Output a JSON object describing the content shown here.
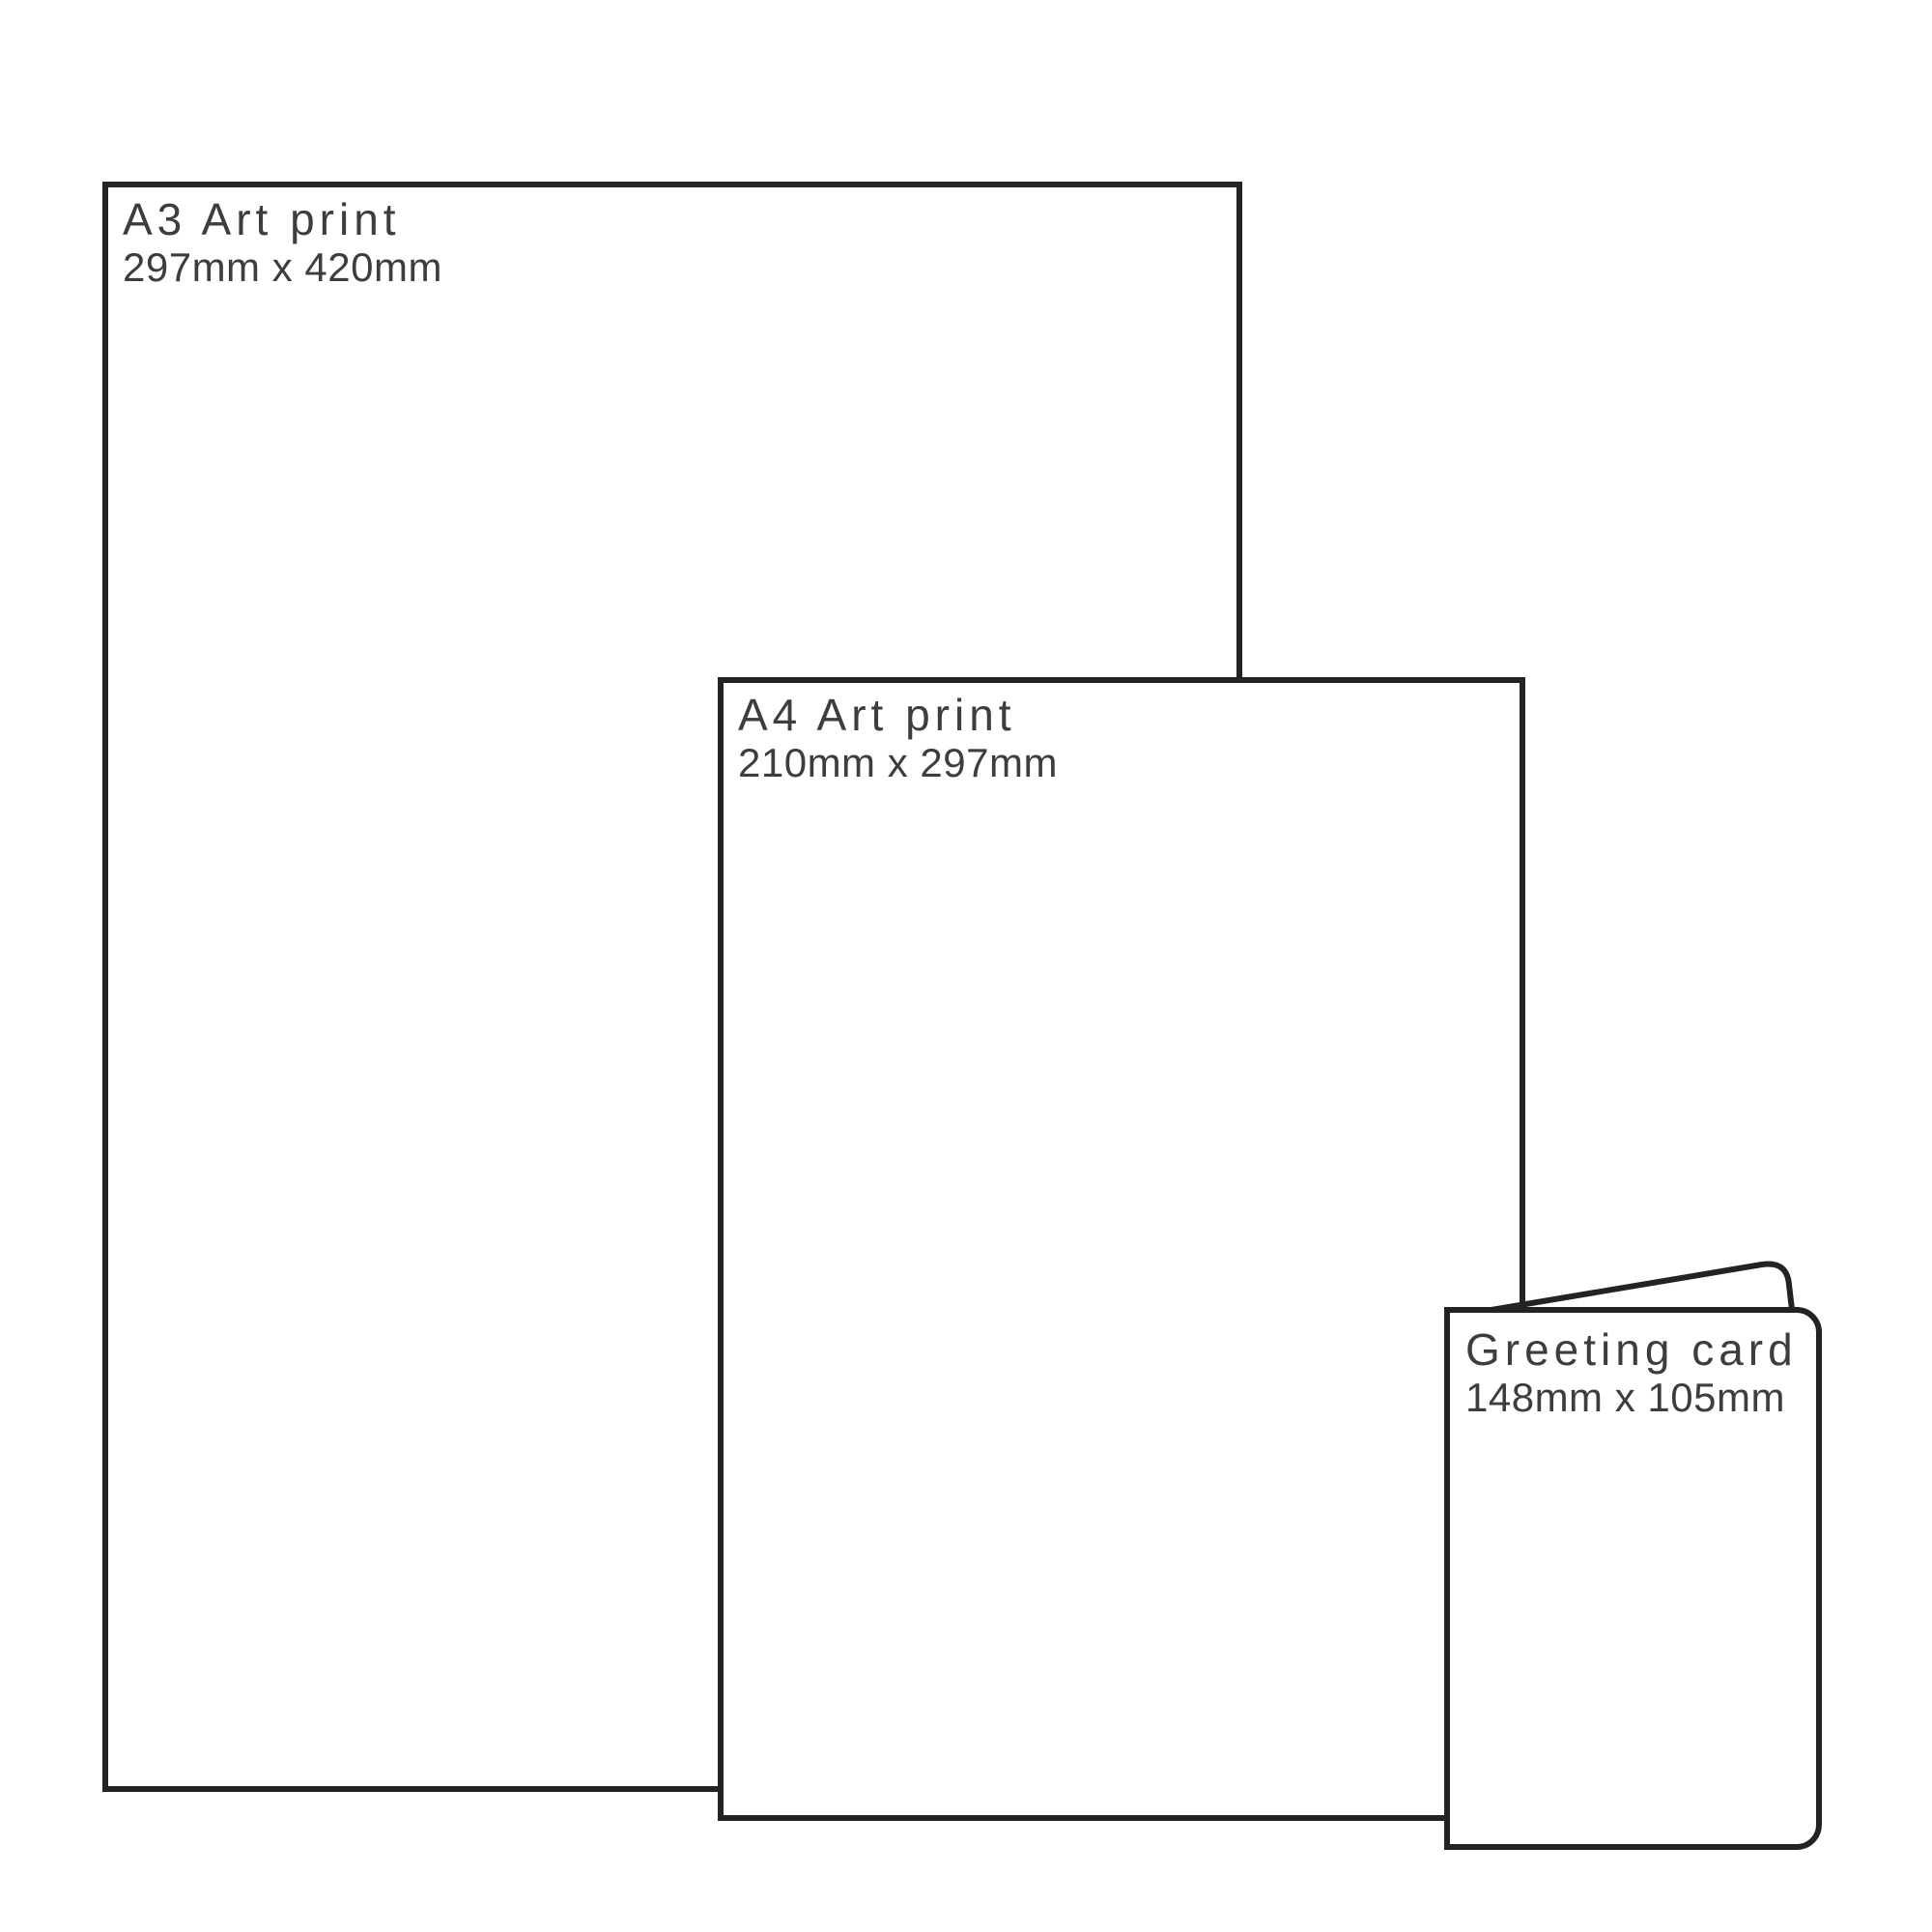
{
  "diagram": {
    "description": "Print size comparison diagram",
    "background_color": "#ffffff",
    "outline_color": "#232323",
    "text_color": "#3d3d3d"
  },
  "items": [
    {
      "id": "a3-art-print",
      "title": "A3 Art print",
      "dimensions": "297mm x 420mm"
    },
    {
      "id": "a4-art-print",
      "title": "A4 Art print",
      "dimensions": "210mm x 297mm"
    },
    {
      "id": "greeting-card",
      "title": "Greeting card",
      "dimensions": "148mm x 105mm"
    }
  ]
}
